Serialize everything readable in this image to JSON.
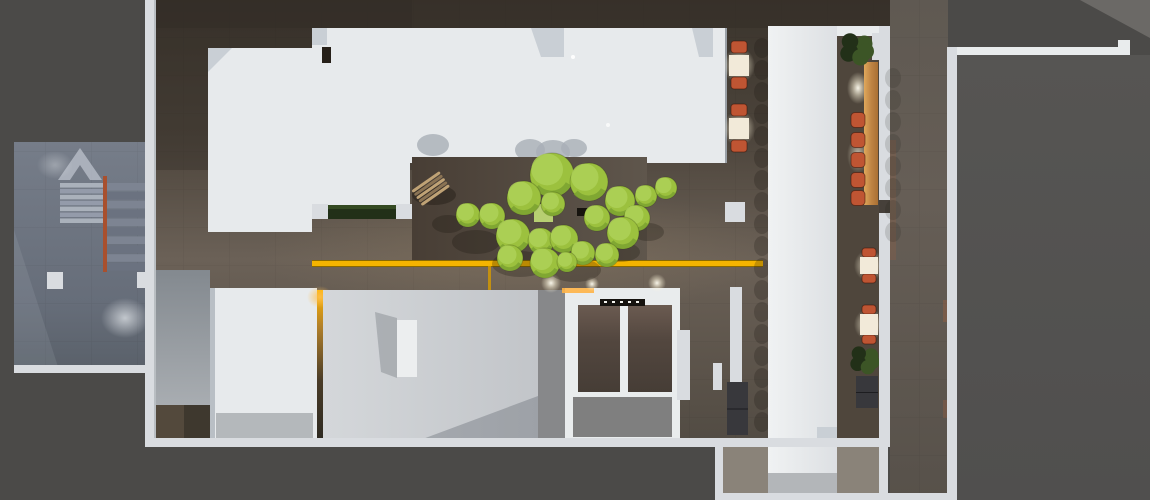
{
  "palette": {
    "bg": "#4b4a48",
    "bg_light_tri": "#6b6966",
    "wall": "#d9dce0",
    "wall_bright": "#e9eced",
    "roof": "#e7eaec",
    "roof_shade": "#c9cfd5",
    "street_dark": "#3e3831",
    "yellow": "#f4b400",
    "chair": "#bf5533",
    "railing": "#a8502e",
    "cabinet": "#38383c",
    "planter": "#223018",
    "tree": "#9cc13e",
    "tree_hi": "#aed158",
    "tree_shade": "#79a02f",
    "tree_pale": "#b7cf72",
    "table_lit": "#f2ead9",
    "gray_band": "#87888a",
    "annex": "#525150",
    "mat": "#53493c",
    "white_desk": "#eceeef",
    "elev_floor": "#7f7f7f",
    "bar_wood": "#c08544",
    "glow_amber": "#ffb446"
  },
  "objects": {
    "trees": {
      "items": [
        [
          552,
          175,
          22
        ],
        [
          589,
          182,
          19
        ],
        [
          524,
          198,
          17
        ],
        [
          620,
          201,
          15
        ],
        [
          646,
          196,
          11
        ],
        [
          666,
          188,
          11
        ],
        [
          468,
          215,
          12
        ],
        [
          492,
          216,
          13
        ],
        [
          553,
          204,
          12
        ],
        [
          597,
          218,
          13
        ],
        [
          637,
          218,
          13
        ],
        [
          513,
          236,
          17
        ],
        [
          541,
          241,
          13
        ],
        [
          564,
          239,
          14
        ],
        [
          623,
          233,
          16
        ],
        [
          510,
          258,
          13
        ],
        [
          545,
          263,
          15
        ],
        [
          583,
          253,
          12
        ],
        [
          607,
          255,
          12
        ],
        [
          567,
          262,
          10
        ]
      ]
    },
    "tree_ground_shadows": [
      [
        448,
        224,
        16,
        9
      ],
      [
        476,
        242,
        24,
        12
      ],
      [
        520,
        264,
        28,
        13
      ],
      [
        575,
        270,
        26,
        12
      ],
      [
        620,
        252,
        20,
        10
      ],
      [
        648,
        232,
        16,
        9
      ]
    ],
    "roof_shadows": [
      [
        433,
        145,
        16,
        11
      ],
      [
        530,
        150,
        15,
        11
      ],
      [
        553,
        152,
        17,
        12
      ],
      [
        574,
        148,
        13,
        9
      ]
    ],
    "stairs": {
      "upper": {
        "x": 60,
        "y": 183,
        "w": 43,
        "steps": 7,
        "step_h": 5.9,
        "c1": "#aab1bb",
        "c2": "#949baa"
      },
      "lower": {
        "x": 106,
        "y": 183,
        "w": 42,
        "steps": 10,
        "step_h": 8.9,
        "c1": "#7d8492",
        "c2": "#6b7280"
      }
    },
    "railing": {
      "x": 103,
      "y": 176,
      "w": 4,
      "h": 96
    },
    "fire_dashes": {
      "x": 145,
      "y0": 300,
      "n": 4,
      "dy": 7,
      "w": 3,
      "h": 4
    },
    "glow_lights": [
      [
        551,
        283,
        10
      ],
      [
        592,
        284,
        7
      ],
      [
        657,
        283,
        9
      ]
    ],
    "corridor_tables": {
      "x": 729,
      "w": 20,
      "h": 21,
      "ys": [
        55,
        118
      ],
      "chair_dy": [
        -14,
        22
      ],
      "chair_w": 16,
      "chair_h": 12
    },
    "wall_tables": {
      "x": 860,
      "w": 18,
      "items": [
        {
          "y": 257,
          "h": 17
        },
        {
          "y": 314,
          "h": 21
        }
      ],
      "chair_w": 14,
      "chair_h": 9
    },
    "bar_stools": {
      "x": 851,
      "w": 14,
      "h": 15,
      "cys": [
        120,
        140,
        160,
        180,
        198
      ]
    },
    "scallop_columns": [
      {
        "x": 762,
        "y0": 48,
        "y1": 436,
        "step": 22,
        "o": 0.22
      },
      {
        "x": 844,
        "y0": 253,
        "y1": 433,
        "step": 22,
        "o": 0.25
      },
      {
        "x": 893,
        "y0": 78,
        "y1": 244,
        "step": 22,
        "o": 0.14
      }
    ],
    "plants": [
      {
        "cx": 856,
        "cy": 49,
        "r": 15
      },
      {
        "cx": 864,
        "cy": 360,
        "r": 13
      }
    ],
    "elevator_ticks": {
      "x0": 604,
      "y": 301,
      "n": 5,
      "dx": 8,
      "w": 3,
      "h": 2
    },
    "columns": [
      [
        47,
        272,
        16,
        17
      ],
      [
        137,
        272,
        14,
        16
      ],
      [
        725,
        202,
        20,
        20
      ]
    ],
    "cabinets": [
      [
        727,
        382,
        21,
        53
      ],
      [
        856,
        376,
        22,
        32
      ]
    ],
    "sculpture": {
      "cx": 431,
      "cy": 189,
      "w": 34,
      "stripe_h": 4,
      "stripes": 5,
      "c1": "#bfa275",
      "c2": "#8a7354",
      "rotation": -35
    }
  }
}
